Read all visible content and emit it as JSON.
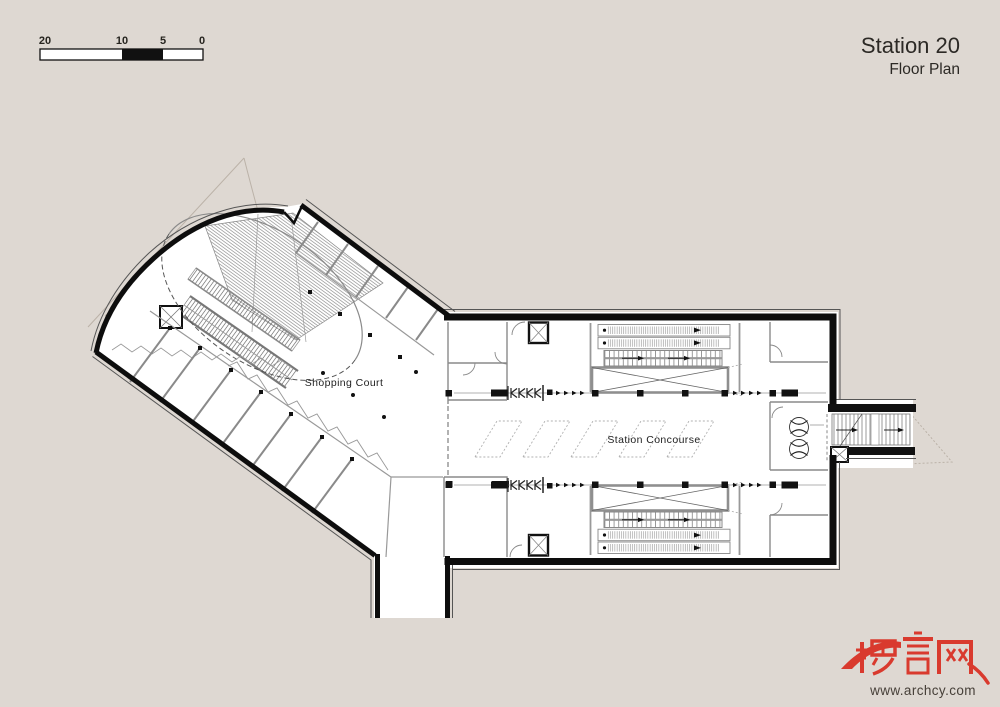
{
  "page": {
    "background_color": "#ded8d2",
    "paper_color": "#ffffff",
    "wall_color": "#111111",
    "partition_color": "#8a8a8a"
  },
  "scale_bar": {
    "labels": [
      "20",
      "10",
      "5",
      "0"
    ]
  },
  "title": {
    "main": "Station 20",
    "sub": "Floor Plan"
  },
  "plan_labels": {
    "shopping_court": "Shopping Court",
    "station_concourse": "Station Concourse"
  },
  "watermark": {
    "logo_text": "畅言网",
    "url": "www.archcy.com",
    "logo_color": "#d93a2e",
    "url_color": "#474039"
  }
}
